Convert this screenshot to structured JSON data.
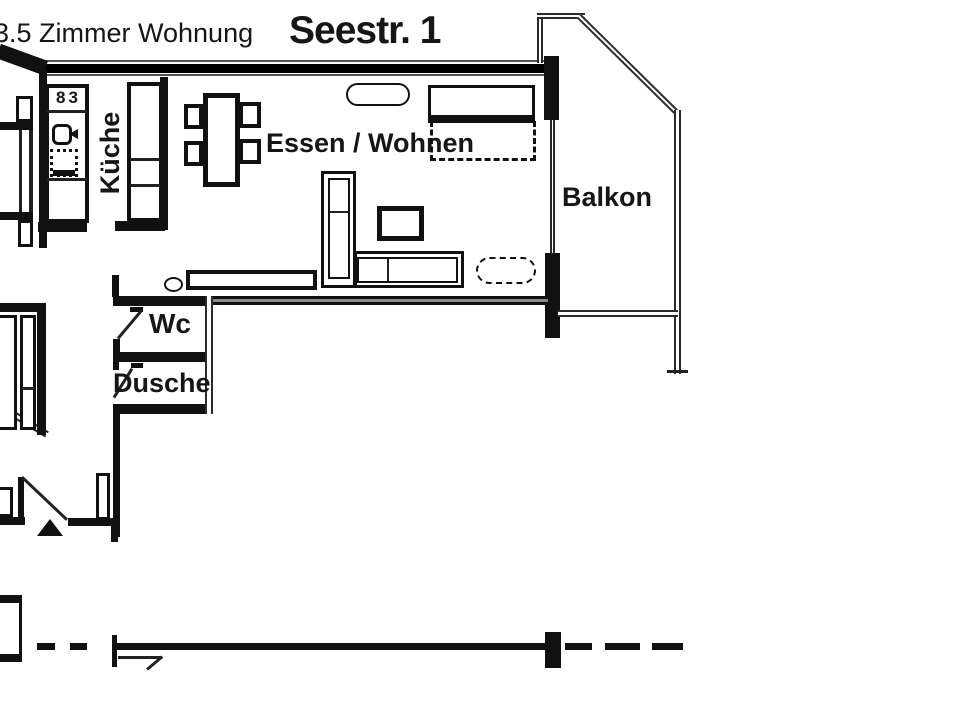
{
  "title": {
    "left_label": "3.5 Zimmer Wohnung",
    "right_label": "Seestr. 1"
  },
  "room_labels": {
    "kitchen": "Küche",
    "living": "Essen / Wohnen",
    "balcony": "Balkon",
    "wc": "Wc",
    "shower": "Dusche"
  },
  "kitchen": {
    "counter_label": "83"
  },
  "colors": {
    "ink": "#111111",
    "background": "#ffffff"
  }
}
